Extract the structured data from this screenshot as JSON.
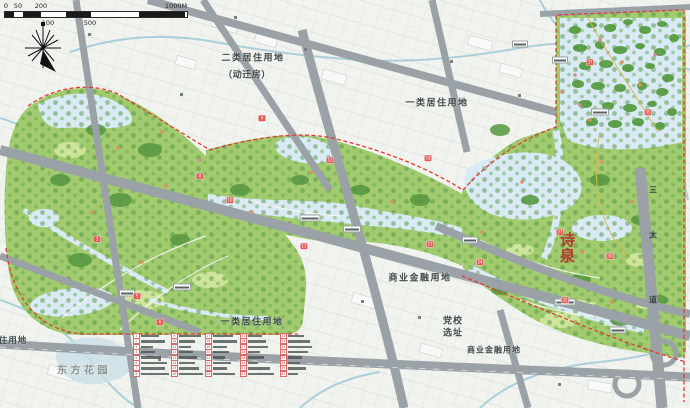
{
  "scalebar": {
    "segments": [
      {
        "x": 0,
        "w": 9,
        "dark": true
      },
      {
        "x": 9,
        "w": 9,
        "dark": false
      },
      {
        "x": 18,
        "w": 18,
        "dark": true
      },
      {
        "x": 36,
        "w": 25,
        "dark": false
      },
      {
        "x": 61,
        "w": 25,
        "dark": true
      },
      {
        "x": 86,
        "w": 48,
        "dark": false
      },
      {
        "x": 134,
        "w": 46,
        "dark": true
      }
    ],
    "ticks": [
      {
        "t": "0",
        "x": 2,
        "row": "top"
      },
      {
        "t": "50",
        "x": 14,
        "row": "top"
      },
      {
        "t": "200",
        "x": 37,
        "row": "top"
      },
      {
        "t": "1000M",
        "x": 172,
        "row": "top"
      },
      {
        "t": "100",
        "x": 44,
        "row": "bottom"
      },
      {
        "t": "500",
        "x": 86,
        "row": "bottom"
      }
    ]
  },
  "area_labels": [
    {
      "text": "二类居住用地",
      "x": 253,
      "y": 57,
      "size": 9,
      "spacing": 1.5
    },
    {
      "text": "（动迁房）",
      "x": 247,
      "y": 74,
      "size": 9,
      "spacing": 0.5
    },
    {
      "text": "一类居住用地",
      "x": 437,
      "y": 102,
      "size": 9,
      "spacing": 1.5
    },
    {
      "text": "商业金融用地",
      "x": 420,
      "y": 277,
      "size": 9,
      "spacing": 1.5
    },
    {
      "text": "党校",
      "x": 453,
      "y": 320,
      "size": 9,
      "spacing": 1
    },
    {
      "text": "选址",
      "x": 453,
      "y": 332,
      "size": 9,
      "spacing": 1
    },
    {
      "text": "商业金融用地",
      "x": 494,
      "y": 350,
      "size": 8,
      "spacing": 1
    },
    {
      "text": "一类居住用地",
      "x": 252,
      "y": 321,
      "size": 9,
      "spacing": 1.5
    },
    {
      "text": "东方花园",
      "x": 84,
      "y": 369,
      "size": 10,
      "spacing": 3.5,
      "color": "#8e948f"
    },
    {
      "text": "住用地",
      "x": 13,
      "y": 340,
      "size": 8.5,
      "spacing": 1
    }
  ],
  "road_label": {
    "chars": [
      {
        "t": "三",
        "x": 653,
        "y": 190
      },
      {
        "t": "太",
        "x": 653,
        "y": 235
      },
      {
        "t": "道",
        "x": 653,
        "y": 300
      }
    ]
  },
  "seal": {
    "text": "诗泉"
  },
  "legend": {
    "row_step": 5.4,
    "top": 334,
    "columns": [
      {
        "x": 133,
        "items": [
          {
            "n": "1",
            "w": 18
          },
          {
            "n": "2",
            "w": 24
          },
          {
            "n": "3",
            "w": 12
          },
          {
            "n": "4",
            "w": 14
          },
          {
            "n": "5",
            "w": 20
          },
          {
            "n": "6",
            "w": 26
          },
          {
            "n": "7",
            "w": 24
          },
          {
            "n": "8",
            "w": 28
          }
        ]
      },
      {
        "x": 171,
        "items": [
          {
            "n": "9",
            "w": 22
          },
          {
            "n": "10",
            "w": 16
          },
          {
            "n": "11",
            "w": 12
          },
          {
            "n": "12",
            "w": 14
          },
          {
            "n": "13",
            "w": 18
          },
          {
            "n": "14",
            "w": 16
          },
          {
            "n": "15",
            "w": 20
          },
          {
            "n": "16",
            "w": 24
          }
        ]
      },
      {
        "x": 205,
        "items": [
          {
            "n": "17",
            "w": 20
          },
          {
            "n": "18",
            "w": 24
          },
          {
            "n": "19",
            "w": 14
          },
          {
            "n": "20",
            "w": 16
          },
          {
            "n": "21",
            "w": 12
          },
          {
            "n": "22",
            "w": 18
          },
          {
            "n": "23",
            "w": 14
          },
          {
            "n": "24",
            "w": 22
          }
        ]
      },
      {
        "x": 240,
        "items": [
          {
            "n": "25",
            "w": 14
          },
          {
            "n": "26",
            "w": 18
          },
          {
            "n": "27",
            "w": 20
          },
          {
            "n": "28",
            "w": 12
          },
          {
            "n": "29",
            "w": 16
          },
          {
            "n": "30",
            "w": 10
          },
          {
            "n": "31",
            "w": 22
          },
          {
            "n": "32",
            "w": 26
          }
        ]
      },
      {
        "x": 280,
        "items": [
          {
            "n": "33",
            "w": 16
          },
          {
            "n": "34",
            "w": 22
          },
          {
            "n": "35",
            "w": 24
          },
          {
            "n": "36",
            "w": 20
          },
          {
            "n": "37",
            "w": 14
          },
          {
            "n": "38",
            "w": 12
          },
          {
            "n": "39",
            "w": 18
          },
          {
            "n": "40",
            "w": 10
          }
        ]
      }
    ]
  },
  "markers": [
    {
      "x": 97,
      "y": 239,
      "n": "3"
    },
    {
      "x": 137,
      "y": 296,
      "n": "5"
    },
    {
      "x": 160,
      "y": 322,
      "n": "6"
    },
    {
      "x": 200,
      "y": 176,
      "n": "8"
    },
    {
      "x": 262,
      "y": 118,
      "n": "9"
    },
    {
      "x": 230,
      "y": 200,
      "n": "10"
    },
    {
      "x": 330,
      "y": 160,
      "n": "12"
    },
    {
      "x": 304,
      "y": 246,
      "n": "13"
    },
    {
      "x": 428,
      "y": 158,
      "n": "18"
    },
    {
      "x": 430,
      "y": 244,
      "n": "21"
    },
    {
      "x": 480,
      "y": 262,
      "n": "24"
    },
    {
      "x": 560,
      "y": 232,
      "n": "27"
    },
    {
      "x": 610,
      "y": 256,
      "n": "30"
    },
    {
      "x": 565,
      "y": 300,
      "n": "32"
    },
    {
      "x": 648,
      "y": 112,
      "n": "35"
    },
    {
      "x": 590,
      "y": 62,
      "n": "37"
    }
  ],
  "chips": [
    {
      "x": 310,
      "y": 218,
      "w": 17
    },
    {
      "x": 182,
      "y": 287,
      "w": 14
    },
    {
      "x": 127,
      "y": 293,
      "w": 12
    },
    {
      "x": 565,
      "y": 302,
      "w": 17
    },
    {
      "x": 600,
      "y": 112,
      "w": 14
    },
    {
      "x": 520,
      "y": 44,
      "w": 12
    },
    {
      "x": 352,
      "y": 229,
      "w": 14
    },
    {
      "x": 470,
      "y": 240,
      "w": 12
    },
    {
      "x": 618,
      "y": 330,
      "w": 13
    },
    {
      "x": 560,
      "y": 60,
      "w": 12
    }
  ],
  "colors": {
    "boundary_red": "#e23b32",
    "road_gray": "#9aa2a7",
    "park_green": "#a2cb70",
    "tree_green": "#4e9340",
    "water_blue": "#d9eaf4",
    "stream_blue": "#a3cbd7",
    "marker_red": "#e25b57",
    "label_text": "#3e4a49"
  }
}
